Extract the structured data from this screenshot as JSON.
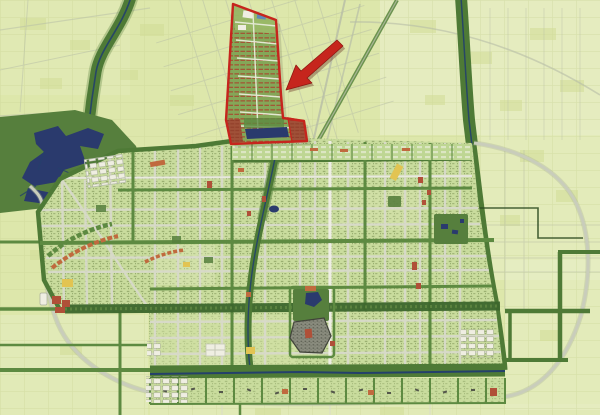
{
  "map": {
    "kind": "urban-master-plan-map",
    "width_px": 600,
    "height_px": 415,
    "visible_text": "none"
  },
  "annotations": {
    "highlight_district": {
      "name": "red-outlined-planned-district",
      "outline_color": "#c6251d",
      "location": "top-center",
      "contents": "green residential blocks with red roof rows, water strip at south end"
    },
    "arrow": {
      "name": "red-arrow",
      "color": "#c6251d",
      "direction": "pointing down-left at highlighted district"
    }
  },
  "legend": [
    {
      "feature": "farmland-fields",
      "color": "#dde7ab"
    },
    {
      "feature": "light-farmland",
      "color": "#e7eec6"
    },
    {
      "feature": "village-patches",
      "color": "#d2dd96"
    },
    {
      "feature": "urban-fabric",
      "color": "#c9dc9d"
    },
    {
      "feature": "green-corridor-river",
      "color": "#4e7a36"
    },
    {
      "feature": "forest-park",
      "color": "#567f3d"
    },
    {
      "feature": "lake-water",
      "color": "#2a3a6d"
    },
    {
      "feature": "city-road",
      "color": "#d9dacc"
    },
    {
      "feature": "ring-road",
      "color": "#c9cdbb"
    },
    {
      "feature": "tree-lined-boulevard",
      "color": "#5d8a41"
    },
    {
      "feature": "central-green-belt",
      "color": "#3c662c"
    },
    {
      "feature": "old-town-core",
      "color": "#8a8c7e"
    },
    {
      "feature": "commercial-red-blocks",
      "color": "#b05038"
    },
    {
      "feature": "orange-housing-rows",
      "color": "#c06a3e"
    },
    {
      "feature": "yellow-facility-blocks",
      "color": "#e2c452"
    },
    {
      "feature": "industrial-white-blocks",
      "color": "#efeee2"
    }
  ],
  "colors": {
    "field_base": "#dde7ab",
    "field_light": "#e7eec6",
    "field_patch": "#d2dd96",
    "field_line": "#c9d494",
    "field_road": "#b6bda6",
    "ring_road": "#c9cdbb",
    "road_gray": "#d9dacc",
    "road_white": "#eeeee4",
    "corridor_green": "#4e7a36",
    "belt_green": "#3c662c",
    "boulevard_green": "#5d8a41",
    "forest_green": "#567f3d",
    "river_navy": "#24406b",
    "lake_navy": "#2a3a6d",
    "city_base": "#c9dc9d",
    "city_texture": "#8fa566",
    "city_texture_dark": "#7d9357",
    "north_blocks": "#bed693",
    "district_fill": "#84a758",
    "district_roof": "#a7492f",
    "district_roof_dark": "#8e3a26",
    "district_panel": "#a05138",
    "highlight_red": "#c6251d",
    "arrow_red": "#c6251d",
    "old_town_gray": "#8a8c7e",
    "old_town_dark": "#54574b",
    "accent_red": "#b05038",
    "accent_orange": "#c06a3e",
    "accent_yellow": "#e2c452",
    "block_white": "#efeee2",
    "block_blue": "#5f88b5",
    "boundary_dark": "#2c4a20"
  }
}
